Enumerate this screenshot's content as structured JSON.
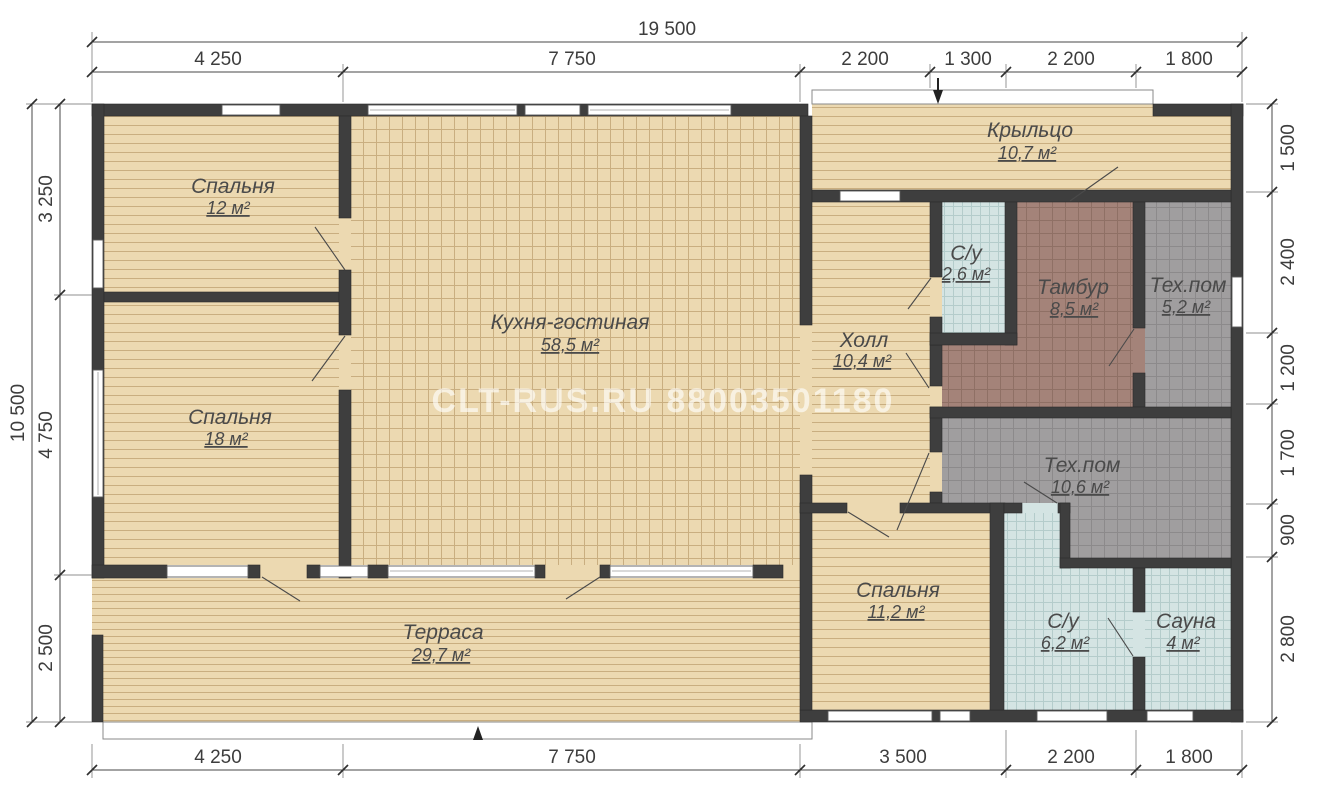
{
  "watermark": "CLT-RUS.RU 88003501180",
  "rooms": {
    "bedroom_top": {
      "label": "Спальня",
      "area": "12 м²"
    },
    "bedroom_left": {
      "label": "Спальня",
      "area": "18 м²"
    },
    "kitchen_living": {
      "label": "Кухня-гостиная",
      "area": "58,5 м²"
    },
    "terrace": {
      "label": "Терраса",
      "area": "29,7 м²"
    },
    "porch": {
      "label": "Крыльцо",
      "area": "10,7 м²"
    },
    "bathroom_small": {
      "label": "С/у",
      "area": "2,6 м²"
    },
    "tambour": {
      "label": "Тамбур",
      "area": "8,5 м²"
    },
    "tech_small": {
      "label": "Тех.пом",
      "area": "5,2 м²"
    },
    "hall": {
      "label": "Холл",
      "area": "10,4 м²"
    },
    "tech_big": {
      "label": "Тех.пом",
      "area": "10,6 м²"
    },
    "bedroom_small": {
      "label": "Спальня",
      "area": "11,2 м²"
    },
    "bathroom_big": {
      "label": "С/у",
      "area": "6,2 м²"
    },
    "sauna": {
      "label": "Сауна",
      "area": "4 м²"
    }
  },
  "dims": {
    "top_total": "19 500",
    "top": [
      "4 250",
      "7 750",
      "2 200",
      "1 300",
      "2 200",
      "1 800"
    ],
    "bottom": [
      "4 250",
      "7 750",
      "3 500",
      "2 200",
      "1 800"
    ],
    "left_total": "10 500",
    "left": [
      "3 250",
      "4 750",
      "2 500"
    ],
    "right": [
      "1 500",
      "2 400",
      "1 200",
      "1 700",
      "900",
      "2 800"
    ]
  }
}
